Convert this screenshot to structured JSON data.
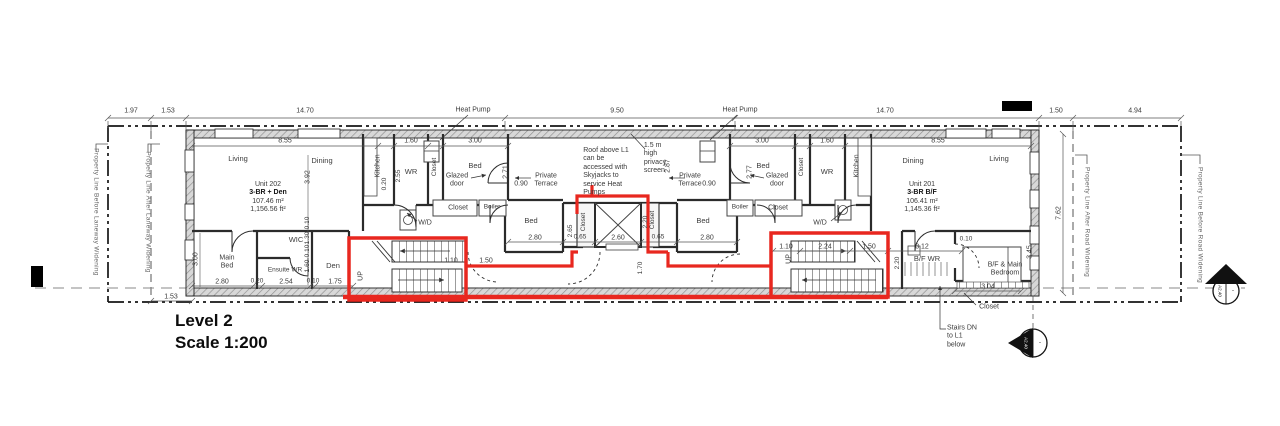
{
  "title": {
    "level": "Level 2",
    "scale": "Scale 1:200"
  },
  "units": {
    "left": {
      "name": "Unit 202",
      "type": "3-BR + Den",
      "area_m2": "107.46 m²",
      "area_ft2": "1,156.56 ft²"
    },
    "right": {
      "name": "Unit 201",
      "type": "3-BR B/F",
      "area_m2": "106.41 m²",
      "area_ft2": "1,145.36 ft²"
    }
  },
  "rooms": {
    "living": "Living",
    "dining": "Dining",
    "kitchen": "Kitchen",
    "wr": "WR",
    "bed": "Bed",
    "closet": "Closet",
    "boiler": "Boiler",
    "wd": "W/D",
    "wic": "WIC",
    "main1": "Main",
    "main2": "Bed",
    "ensuite": "Ensuite WR",
    "den": "Den",
    "bf_wr": "B/F WR",
    "bf1": "B/F & Main",
    "bf2": "Bedroom",
    "up": "UP",
    "glazed1": "Glazed",
    "glazed2": "door",
    "terr1": "Private",
    "terr2": "Terrace",
    "heat_pump": "Heat Pump"
  },
  "notes": {
    "roof": [
      "Roof above L1",
      "can be",
      "accessed with",
      "Skyjacks to",
      "service Heat",
      "Pumps"
    ],
    "privacy": [
      "1.5 m",
      "high",
      "privacy",
      "screen"
    ],
    "stairs_dn": [
      "Stairs DN",
      "to L1",
      "below"
    ]
  },
  "dims": {
    "top": [
      "1.97",
      "1.53",
      "14.70",
      "9.50",
      "14.70",
      "1.50",
      "4.94"
    ],
    "row2_left": [
      "8.55",
      "1.60",
      "3.00"
    ],
    "row2_right": [
      "3.00",
      "1.60",
      "8.55"
    ],
    "left_unit": {
      "living_depth": "3.92",
      "k020": "0.20",
      "wr_depth": "2.55",
      "bed_depth": "2.71",
      "glazed": "0.90",
      "main_bed_h": "3.00",
      "b1": "2.80",
      "b2": "0.20",
      "b3": "2.54",
      "b4": "0.10",
      "b5": "1.75",
      "lane": "1.53",
      "c110": "1.10",
      "c150": "1.50",
      "v010a": "0.10",
      "v130": "1.30",
      "v010b": "0.10",
      "v160": "1.60"
    },
    "core": {
      "s1": "0.65",
      "lift_w": "2.60",
      "s2": "0.65",
      "lift_d": "2.20",
      "lobby": "1.70",
      "bed_l": "2.80",
      "bed_l_d": "2.65",
      "bed_r": "2.80",
      "screen": "2.87",
      "glazed": "0.90"
    },
    "right_unit": {
      "bed_depth": "2.77",
      "s110": "1.10",
      "s224": "2.24",
      "s150": "1.50",
      "stair_d": "2.20",
      "wr_w": "3.12",
      "g010": "0.10",
      "bed_w": "3.04",
      "bed_d": "3.45"
    },
    "site_right": "7.62"
  },
  "property": {
    "before_lane": "Property Line Before Laneway Widening",
    "after_lane": "Property Line After Laneway Widening",
    "after_road": "Property Line After Road Widening",
    "before_road": "Property Line Before Road Widening"
  },
  "markers": {
    "section": "A2.40",
    "blank": "-"
  },
  "colors": {
    "highlight": "#e8271f"
  }
}
